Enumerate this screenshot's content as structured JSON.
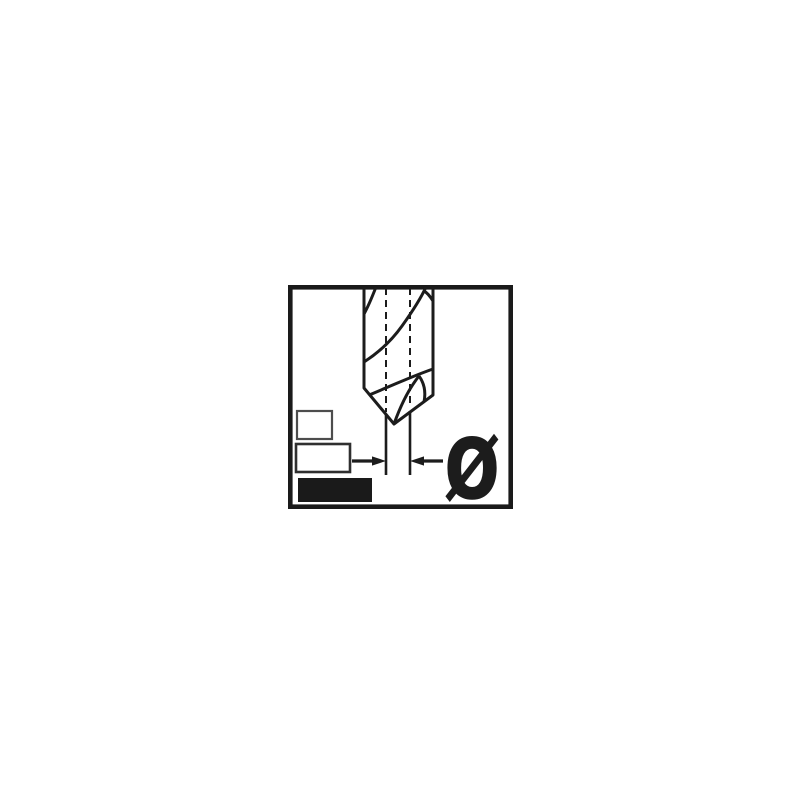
{
  "figure": {
    "kind": "technical-pictogram",
    "subject": "drill-bit-diameter",
    "symbols": {
      "diameter": "Ø"
    },
    "colors": {
      "background": "#ffffff",
      "line": "#1c1c1c",
      "frame": "#1a1a1a",
      "legend_outline_small": "#4d4d4d",
      "legend_outline_medium": "#2f2f2f",
      "legend_fill": "#1a1a1a"
    },
    "icons": [
      {
        "name": "drill-bit-icon"
      },
      {
        "name": "centerline-dashed-icon"
      },
      {
        "name": "dimension-extension-lines-icon"
      },
      {
        "name": "dimension-arrows-icon"
      },
      {
        "name": "legend-small-outline-rect-icon"
      },
      {
        "name": "legend-medium-outline-rect-icon"
      },
      {
        "name": "legend-filled-rect-icon"
      },
      {
        "name": "diameter-symbol-icon",
        "glyph": "Ø"
      }
    ]
  }
}
